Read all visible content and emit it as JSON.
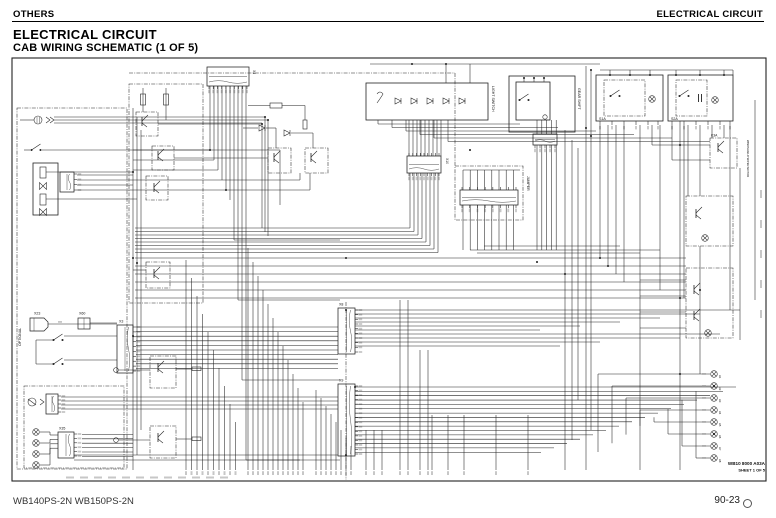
{
  "page": {
    "header_left": "OTHERS",
    "header_right": "ELECTRICAL CIRCUIT",
    "title": "ELECTRICAL CIRCUIT",
    "subtitle": "CAB WIRING SCHEMATIC (1 OF 5)",
    "footer_left": "WB140PS-2N WB150PS-2N",
    "footer_page": "90-23"
  },
  "diagram": {
    "sheet_code": "WB10 8000 A03A",
    "sheet_number": "SHEET 1 OF 5",
    "labels": {
      "light_switch": "LIGHT SWITCH",
      "gear_shift": "GEAR SHIFT",
      "jumper": "JUMPER",
      "optional": "OPTIONAL",
      "wiper_motor": "WINDSHIELD WIPER MOTOR",
      "s1a": "S1A",
      "s2a": "S2A",
      "k3a": "K3A",
      "x4": "X4",
      "x10": "X10",
      "x23": "X23",
      "x60": "X60",
      "x3": "X3",
      "x8": "X8",
      "x9": "X9",
      "x35": "X35"
    },
    "lamp_labels": [
      "H1",
      "H2",
      "H3",
      "H4",
      "H5",
      "H6",
      "H7",
      "H8"
    ]
  }
}
